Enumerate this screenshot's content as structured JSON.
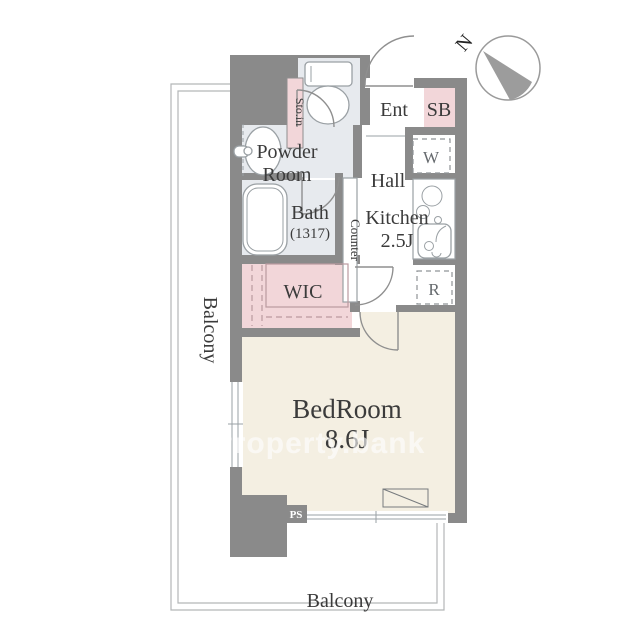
{
  "watermark": {
    "text": "Property.bank"
  },
  "compass": {
    "north_label": "N"
  },
  "rooms": {
    "balcony_left": {
      "label": "Balcony"
    },
    "balcony_bottom": {
      "label": "Balcony"
    },
    "bedroom": {
      "label": "BedRoom",
      "size": "8.6J"
    },
    "wic": {
      "label": "WIC"
    },
    "bath": {
      "label": "Bath",
      "size": "(1317)"
    },
    "powder_room": {
      "label_line1": "Powder",
      "label_line2": "Room"
    },
    "kitchen": {
      "label": "Kitchen",
      "size": "2.5J"
    },
    "hall": {
      "label": "Hall"
    },
    "entrance": {
      "label": "Ent"
    },
    "shoe_box": {
      "label": "SB"
    },
    "storage": {
      "label": "Sto.in"
    },
    "counter": {
      "label": "Counter"
    },
    "washer_space": {
      "label": "W"
    },
    "refrigerator_space": {
      "label": "R"
    },
    "pipe_space": {
      "label": "PS"
    }
  },
  "colors": {
    "wall": "#8a8a8a",
    "pink": "#f2d6d9",
    "service": "#e7eaee",
    "cream": "#f4efe2",
    "line": "#9aa0a4",
    "text": "#3b3b3b",
    "balcony_line": "#b3b6b8"
  }
}
